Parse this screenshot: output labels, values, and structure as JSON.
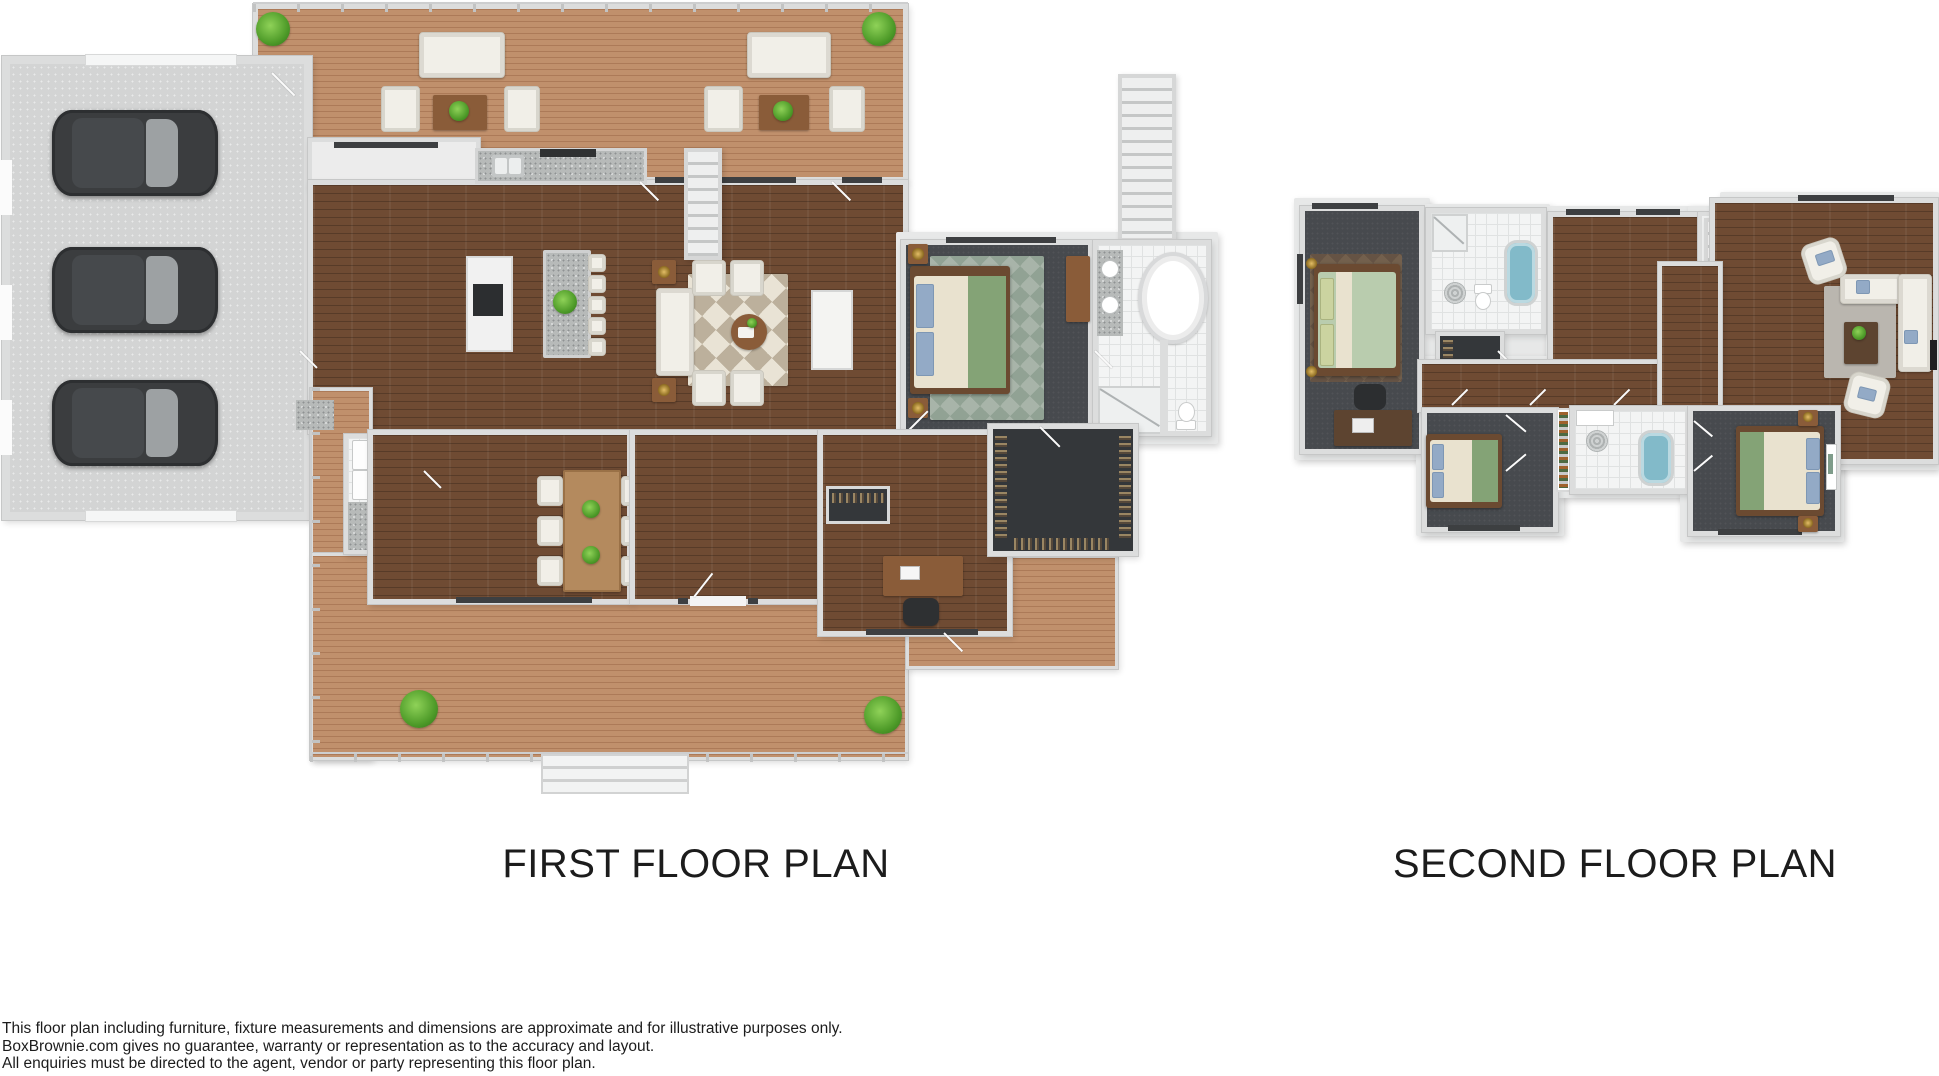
{
  "plans": {
    "first": {
      "title": "FIRST FLOOR PLAN"
    },
    "second": {
      "title": "SECOND FLOOR PLAN"
    }
  },
  "disclaimer": {
    "line1": "This floor plan including furniture, fixture measurements and dimensions are approximate and for illustrative purposes only.",
    "line2": "BoxBrownie.com gives no guarantee, warranty or representation as to the accuracy and layout.",
    "line3": "All enquiries must be directed to the agent, vendor or party representing this floor plan."
  },
  "palette": {
    "wall": "#dcdddd",
    "wallshade": "#c6c7c7",
    "wood": "#6f4b33",
    "deck": "#c0906c",
    "garage": "#d3d4d4",
    "charcoal": "#474a4e",
    "closet": "#34373a",
    "tile": "#f3f4f4",
    "granite": "#b7bab9",
    "rug1": "#e9e3d5",
    "rug2": "#bcb09c",
    "sofa": "#f1efe8",
    "furnwood": "#8a5c39",
    "bedgreen": "#84a376",
    "bedcream": "#e9e2cf",
    "pillowblue": "#93aac6",
    "plant": "#55a231",
    "car": "#3b3d3f",
    "tubblue": "#82bac9",
    "text": "#1c1c1c"
  }
}
